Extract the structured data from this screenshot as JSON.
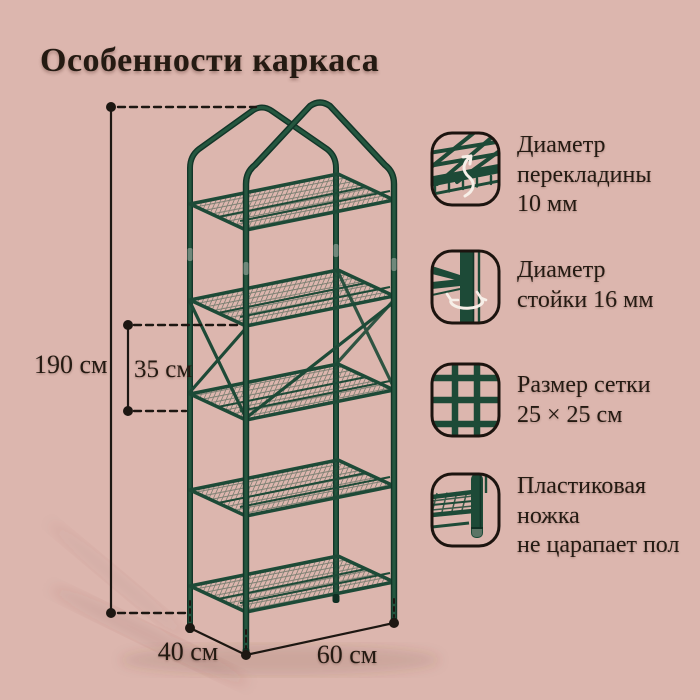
{
  "title": "Особенности каркаса",
  "colors": {
    "background": "#dcb6ae",
    "text": "#241a12",
    "frame_green": "#1d4a37",
    "frame_green_dark": "#123528",
    "annotation_black": "#1d1712",
    "arrow_white": "#f7efe8"
  },
  "dimensions": {
    "height": "190 см",
    "tier_gap": "35 см",
    "depth": "40 см",
    "width": "60 см"
  },
  "callouts": [
    {
      "icon": "crossbar-diameter-icon",
      "lines": [
        "Диаметр",
        "перекладины",
        "10 мм"
      ]
    },
    {
      "icon": "post-diameter-icon",
      "lines": [
        "Диаметр",
        "стойки 16 мм"
      ]
    },
    {
      "icon": "mesh-size-icon",
      "lines": [
        "Размер сетки",
        "25 × 25 см"
      ]
    },
    {
      "icon": "plastic-foot-icon",
      "lines": [
        "Пластиковая",
        "ножка",
        "не царапает пол"
      ]
    }
  ],
  "illustration": {
    "shelves": 5
  }
}
